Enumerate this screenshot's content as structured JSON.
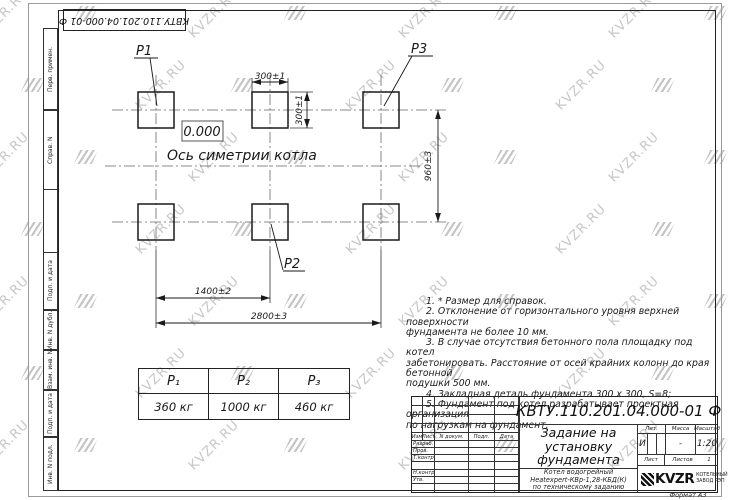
{
  "colors": {
    "ink": "#1a1a1a",
    "watermark": "#c7c7c7"
  },
  "watermark": {
    "text": "KVZR.RU"
  },
  "stamp_top": {
    "text": "КВТУ.110.201.04.000-01  Ф"
  },
  "side_labels": [
    "Перв. примен.",
    "Справ. N",
    "Подп. и дата",
    "Инв. N дубл.",
    "Взам. инв. N",
    "Подп. и дата",
    "Инв. N подл."
  ],
  "plan": {
    "labels": {
      "p1": "P1",
      "p2": "P2",
      "p3": "P3"
    },
    "zero_mark": "0.000",
    "axis_label": "Ось симетрии котла",
    "dims": {
      "w300h": "300±1",
      "w300v": "300±1",
      "h960": "960±3",
      "w1400": "1400±2",
      "w2800": "2800±3"
    }
  },
  "load_table": {
    "headers": [
      "P₁",
      "P₂",
      "P₃"
    ],
    "values": [
      "360  кг",
      "1000  кг",
      "460  кг"
    ]
  },
  "notes": {
    "lines": [
      "1.  * Размер для справок.",
      "2.  Отклонение от горизонтального уровня верхней поверхности",
      "фундамента не более  10  мм.",
      "3.  В случае отсутствия бетонного пола площадку под котел",
      "забетонировать. Расстояние от осей крайних колонн до края бетонной",
      "подушки  500  мм.",
      "4.  Закладная деталь фундамента   300 x 300,  S=8;",
      "5.  Фундамент под котел разрабатывает проектная организация",
      "по нагрузкам на фундамент."
    ]
  },
  "title_block": {
    "doc_number": "КВТУ.110.201.04.000-01  Ф",
    "title_lines": [
      "Задание на",
      "установку",
      "фундамента"
    ],
    "product_lines": [
      "Котел водогрейный",
      "Heatexpert-КВр-1,28-КБД(К)",
      "по техническому заданию"
    ],
    "header_cols": [
      "Изм",
      "Лист",
      "N докум.",
      "Подп.",
      "Дата"
    ],
    "row_labels": [
      "Разраб.",
      "Пров.",
      "Т.контр.",
      "",
      "Н.контр.",
      "Утв."
    ],
    "lit_label": "Лит.",
    "mass_label": "Масса",
    "scale_label": "Масштаб",
    "lit_value": "И",
    "mass_value": "-",
    "scale_value": "1:20",
    "sheet_label": "Лист",
    "sheets_label": "Листов",
    "sheets_value": "1",
    "logo_text": "KVZR",
    "logo_caption_lines": [
      "КОТЕЛЬНЫЙ",
      "ЗАВОД РЭП"
    ],
    "format_label": "Формат А3"
  }
}
